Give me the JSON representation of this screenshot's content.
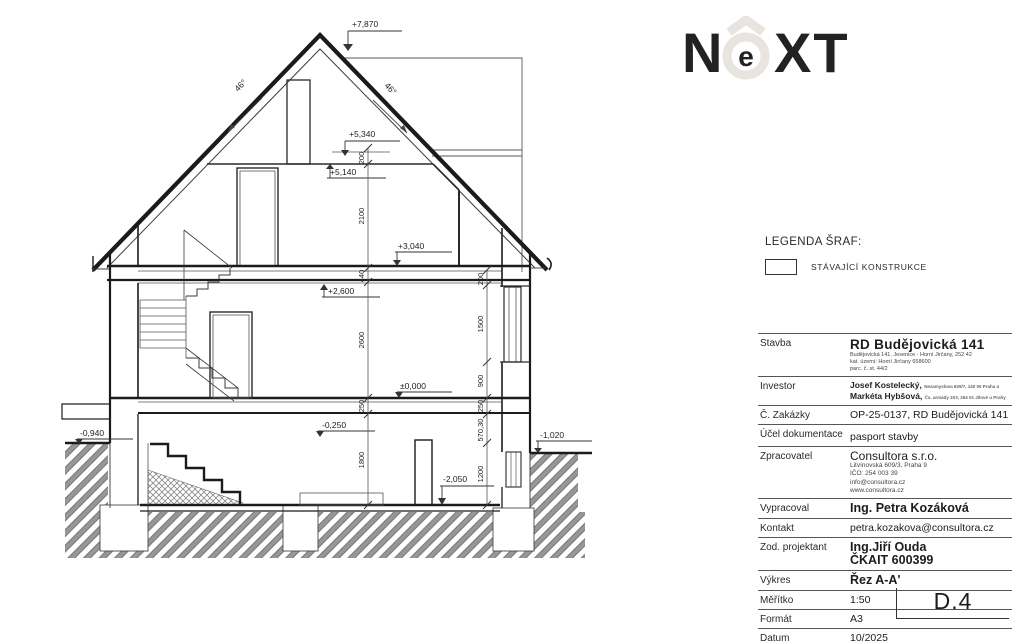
{
  "logo": {
    "letter_n": "N",
    "letter_e": "e",
    "letters_xt": "XT",
    "color": "#e8e5e1"
  },
  "legend": {
    "title": "LEGENDA ŠRAF:",
    "item_label": "STÁVAJÍCÍ KONSTRUKCE"
  },
  "title_block": {
    "rows": {
      "stavba": {
        "label": "Stavba",
        "value": "RD Budějovická 141",
        "small1": "Budějovická 141, Jesenice - Horní Jirčany, 252 42",
        "small2": "kat. území: Horní Jirčany 658600",
        "small3": "parc. č. st. 44/2"
      },
      "investor": {
        "label": "Investor",
        "line1": "Josef Kostelecký,",
        "line1_small": "Nezamyslova 829/7, 140 00 Praha 4",
        "line2": "Markéta Hybšová,",
        "line2_small": "Čs. armády 203, 254 01 Jílové u Prahy"
      },
      "zakazky": {
        "label": "Č. Zakázky",
        "value": "OP-25-0137, RD Budějovická 141"
      },
      "ucel": {
        "label": "Účel dokumentace",
        "value": "pasport stavby"
      },
      "zpracovatel": {
        "label": "Zpracovatel",
        "value": "Consultora s.r.o.",
        "small1": "Litvínovská 609/3, Praha 9",
        "small2": "IČO: 254 003 39",
        "small3": "info@consultora.cz",
        "small4": "www.consultora.cz"
      },
      "vypracoval": {
        "label": "Vypracoval",
        "value": "Ing. Petra Kozáková"
      },
      "kontakt": {
        "label": "Kontakt",
        "value": "petra.kozakova@consultora.cz"
      },
      "projektant": {
        "label": "Zod. projektant",
        "value": "Ing.Jiří Ouda",
        "value2": "ČKAIT 600399"
      },
      "vykres": {
        "label": "Výkres",
        "value": "Řez A-A'"
      },
      "meritko": {
        "label": "Měřítko",
        "value": "1:50"
      },
      "format": {
        "label": "Formát",
        "value": "A3"
      },
      "datum": {
        "label": "Datum",
        "value": "10/2025"
      }
    }
  },
  "drawing_number": "D.4",
  "drawing": {
    "levels": {
      "ridge": "+7,870",
      "collar": "+5,340",
      "attic_ceiling": "+5,140",
      "attic_floor": "+3,040",
      "gf_ceiling": "+2,600",
      "gf_floor": "±0,000",
      "gf_slab": "-0,250",
      "terrain_left": "-0,940",
      "terrain_right": "-1,020",
      "basement_floor": "-2,050"
    },
    "roof_angle_left": "46°",
    "roof_angle_right": "46°",
    "dims_center": {
      "d0": "200",
      "d1": "2100",
      "d2": "440",
      "d3": "2600",
      "d4": "250",
      "d5": "1800"
    },
    "dims_right": {
      "d0": "200",
      "d1": "1500",
      "d2": "900",
      "d3": "250",
      "d4": "570,30",
      "d5": "1200"
    }
  }
}
